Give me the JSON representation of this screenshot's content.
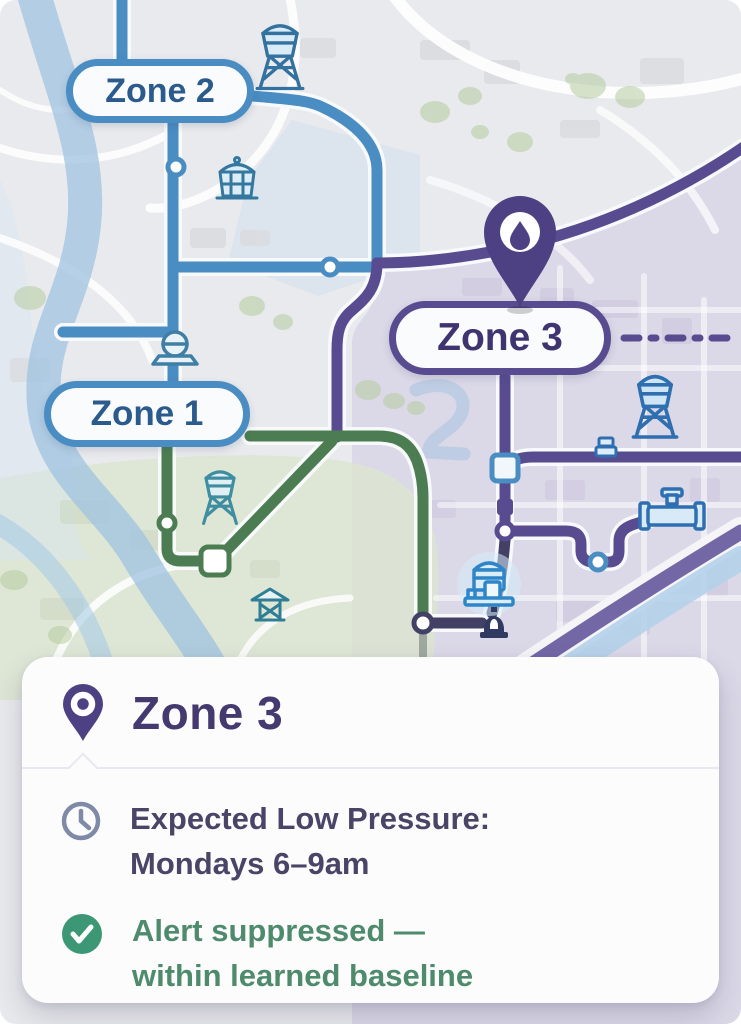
{
  "colors": {
    "map_background": "#e9eaed",
    "zone_blue": "#4a8dc3",
    "zone_blue_text": "#2b5a8c",
    "zone_purple": "#584b90",
    "zone_purple_text": "#3f3470",
    "pipe_green": "#4c7d52",
    "pipe_dark": "#434066",
    "pin_purple": "#4e4183",
    "card_background": "#fcfcfd",
    "card_title_text": "#453a6f",
    "info_text": "#4a4467",
    "info_icon": "#7f8aa7",
    "success_text": "#4e8a6c",
    "success_icon": "#3c9874"
  },
  "map": {
    "pills": [
      {
        "label": "Zone 1"
      },
      {
        "label": "Zone 2"
      },
      {
        "label": "Zone 3"
      }
    ],
    "marker": {
      "zone": "Zone 3",
      "icon": "water-drop-pin"
    },
    "icon_names": [
      "water-tower",
      "reservoir-tank",
      "pump-dome",
      "water-tower-teal",
      "pavilion",
      "water-tower-large",
      "valve",
      "valve-assembly",
      "pump-station",
      "hydrant"
    ]
  },
  "card": {
    "title": "Zone 3",
    "title_icon": "map-pin",
    "rows": [
      {
        "icon": "clock",
        "line1": "Expected Low Pressure:",
        "line2": "Mondays 6–9am"
      },
      {
        "icon": "check",
        "line1": "Alert suppressed —",
        "line2": "within learned baseline"
      }
    ]
  }
}
